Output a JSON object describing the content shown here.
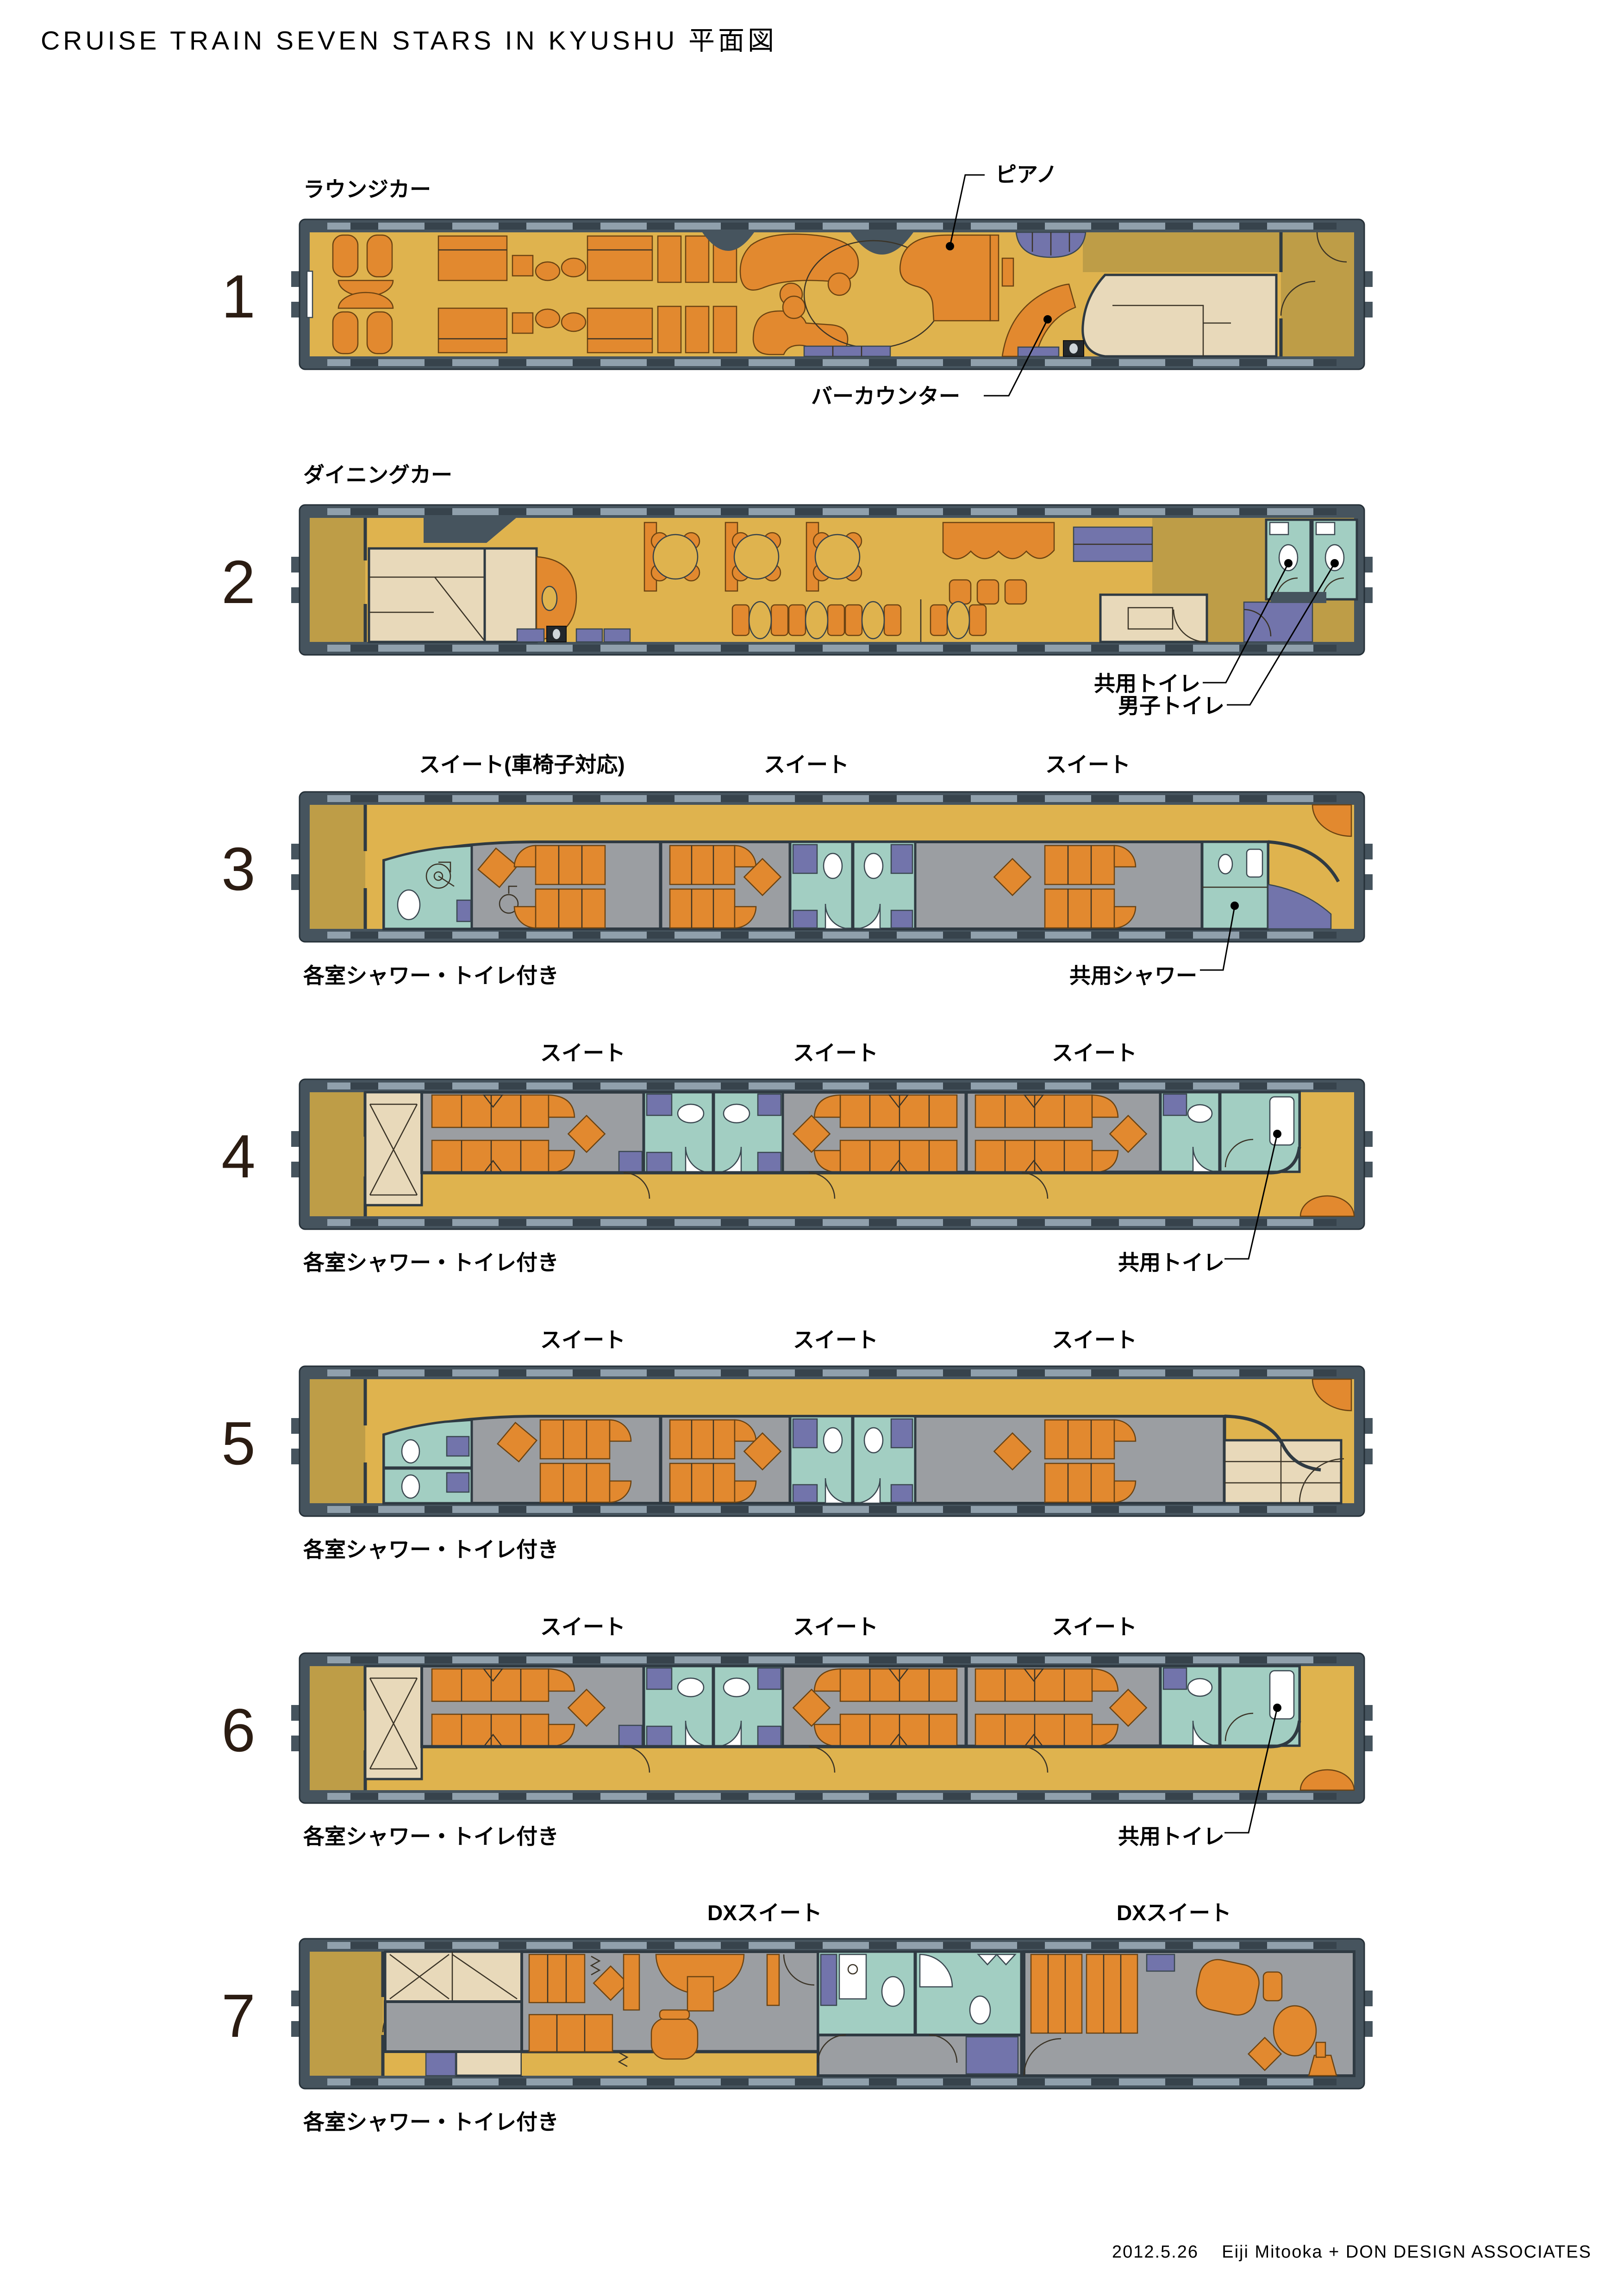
{
  "title": "CRUISE TRAIN SEVEN STARS IN KYUSHU 平面図",
  "footer": "2012.5.26    Eiji Mitooka + DON DESIGN ASSOCIATES",
  "palette": {
    "floor_gold": "#DFB34E",
    "vestibule_khaki": "#BE9D47",
    "furniture_orange": "#E2892F",
    "bathroom_teal": "#A2CEC2",
    "cabinet_purple": "#7274AB",
    "car_body_gray": "#46545E",
    "room_floor_gray": "#9B9EA2",
    "kitchen_beige": "#E8D9BA"
  },
  "cars": [
    {
      "number": "1",
      "name": "ラウンジカー",
      "annotations": {
        "piano": "ピアノ",
        "bar": "バーカウンター"
      }
    },
    {
      "number": "2",
      "name": "ダイニングカー",
      "annotations": {
        "shared_toilet": "共用トイレ",
        "mens_toilet": "男子トイレ"
      }
    },
    {
      "number": "3",
      "suites": [
        "スイート(車椅子対応)",
        "スイート",
        "スイート"
      ],
      "note": "各室シャワー・トイレ付き",
      "annotations": {
        "shared_shower": "共用シャワー"
      }
    },
    {
      "number": "4",
      "suites": [
        "スイート",
        "スイート",
        "スイート"
      ],
      "note": "各室シャワー・トイレ付き",
      "annotations": {
        "shared_toilet": "共用トイレ"
      }
    },
    {
      "number": "5",
      "suites": [
        "スイート",
        "スイート",
        "スイート"
      ],
      "note": "各室シャワー・トイレ付き"
    },
    {
      "number": "6",
      "suites": [
        "スイート",
        "スイート",
        "スイート"
      ],
      "note": "各室シャワー・トイレ付き",
      "annotations": {
        "shared_toilet": "共用トイレ"
      }
    },
    {
      "number": "7",
      "suites": [
        "DXスイート",
        "DXスイート"
      ],
      "note": "各室シャワー・トイレ付き"
    }
  ]
}
